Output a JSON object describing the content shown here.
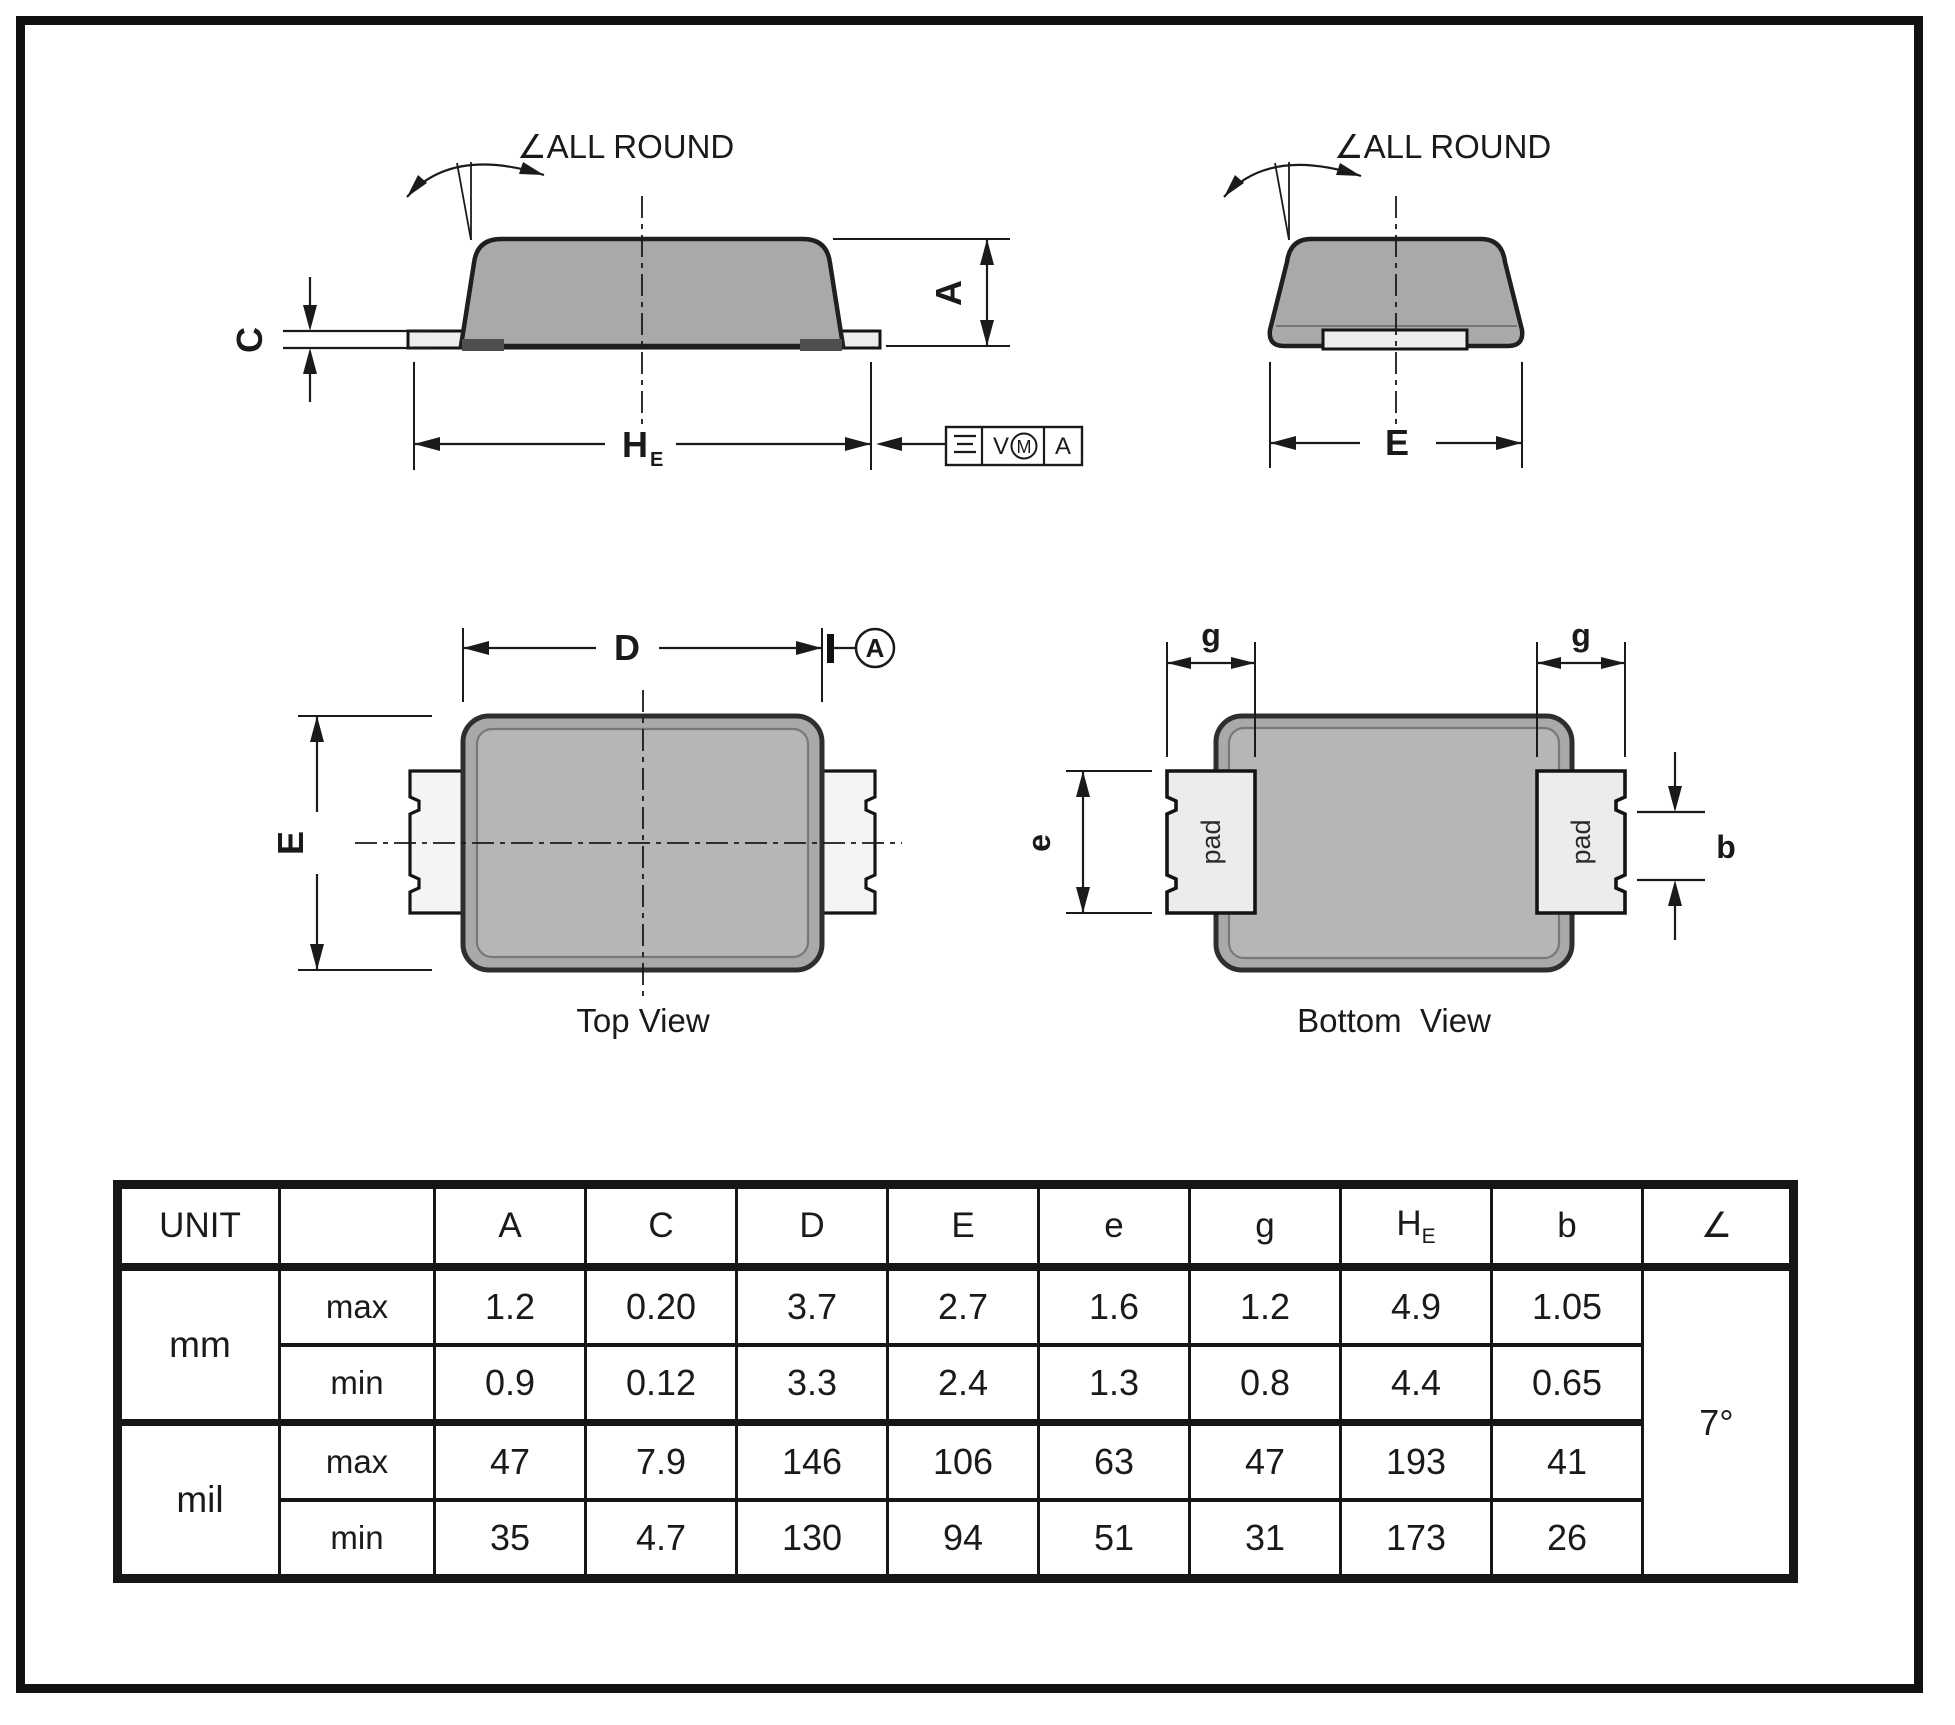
{
  "colors": {
    "ink": "#1a1a1a",
    "frame_border": "#111111",
    "body_gray": "#a9a9a9",
    "body_gray_light": "#b6b6b6",
    "pad_light": "#ededed",
    "lead_white": "#f4f4f4",
    "foot_dark": "#4f4f4f"
  },
  "side_view": {
    "angle_callout": "∠ALL ROUND",
    "dim_c": "C",
    "dim_he_main": "H",
    "dim_he_sub": "E",
    "dim_a": "A",
    "fcf": {
      "tolerance": "V",
      "modifier": "M",
      "datum": "A"
    }
  },
  "end_view": {
    "angle_callout": "∠ALL ROUND",
    "dim_e": "E"
  },
  "top_view": {
    "dim_d": "D",
    "dim_e": "E",
    "datum": "A",
    "caption": "Top View"
  },
  "bottom_view": {
    "dim_g_left": "g",
    "dim_g_right": "g",
    "dim_e": "e",
    "dim_b": "b",
    "pad_left": "pad",
    "pad_right": "pad",
    "caption": "Bottom  View"
  },
  "table": {
    "unit_header": "UNIT",
    "headers": {
      "a": "A",
      "c": "C",
      "d": "D",
      "e_upper": "E",
      "e_lower": "e",
      "g": "g",
      "he_main": "H",
      "he_sub": "E",
      "b": "b",
      "angle": "∠"
    },
    "groups": [
      {
        "unit": "mm",
        "rows": [
          {
            "limit": "max",
            "values": [
              "1.2",
              "0.20",
              "3.7",
              "2.7",
              "1.6",
              "1.2",
              "4.9",
              "1.05"
            ]
          },
          {
            "limit": "min",
            "values": [
              "0.9",
              "0.12",
              "3.3",
              "2.4",
              "1.3",
              "0.8",
              "4.4",
              "0.65"
            ]
          }
        ]
      },
      {
        "unit": "mil",
        "rows": [
          {
            "limit": "max",
            "values": [
              "47",
              "7.9",
              "146",
              "106",
              "63",
              "47",
              "193",
              "41"
            ]
          },
          {
            "limit": "min",
            "values": [
              "35",
              "4.7",
              "130",
              "94",
              "51",
              "31",
              "173",
              "26"
            ]
          }
        ]
      }
    ],
    "angle_value": "7°"
  }
}
